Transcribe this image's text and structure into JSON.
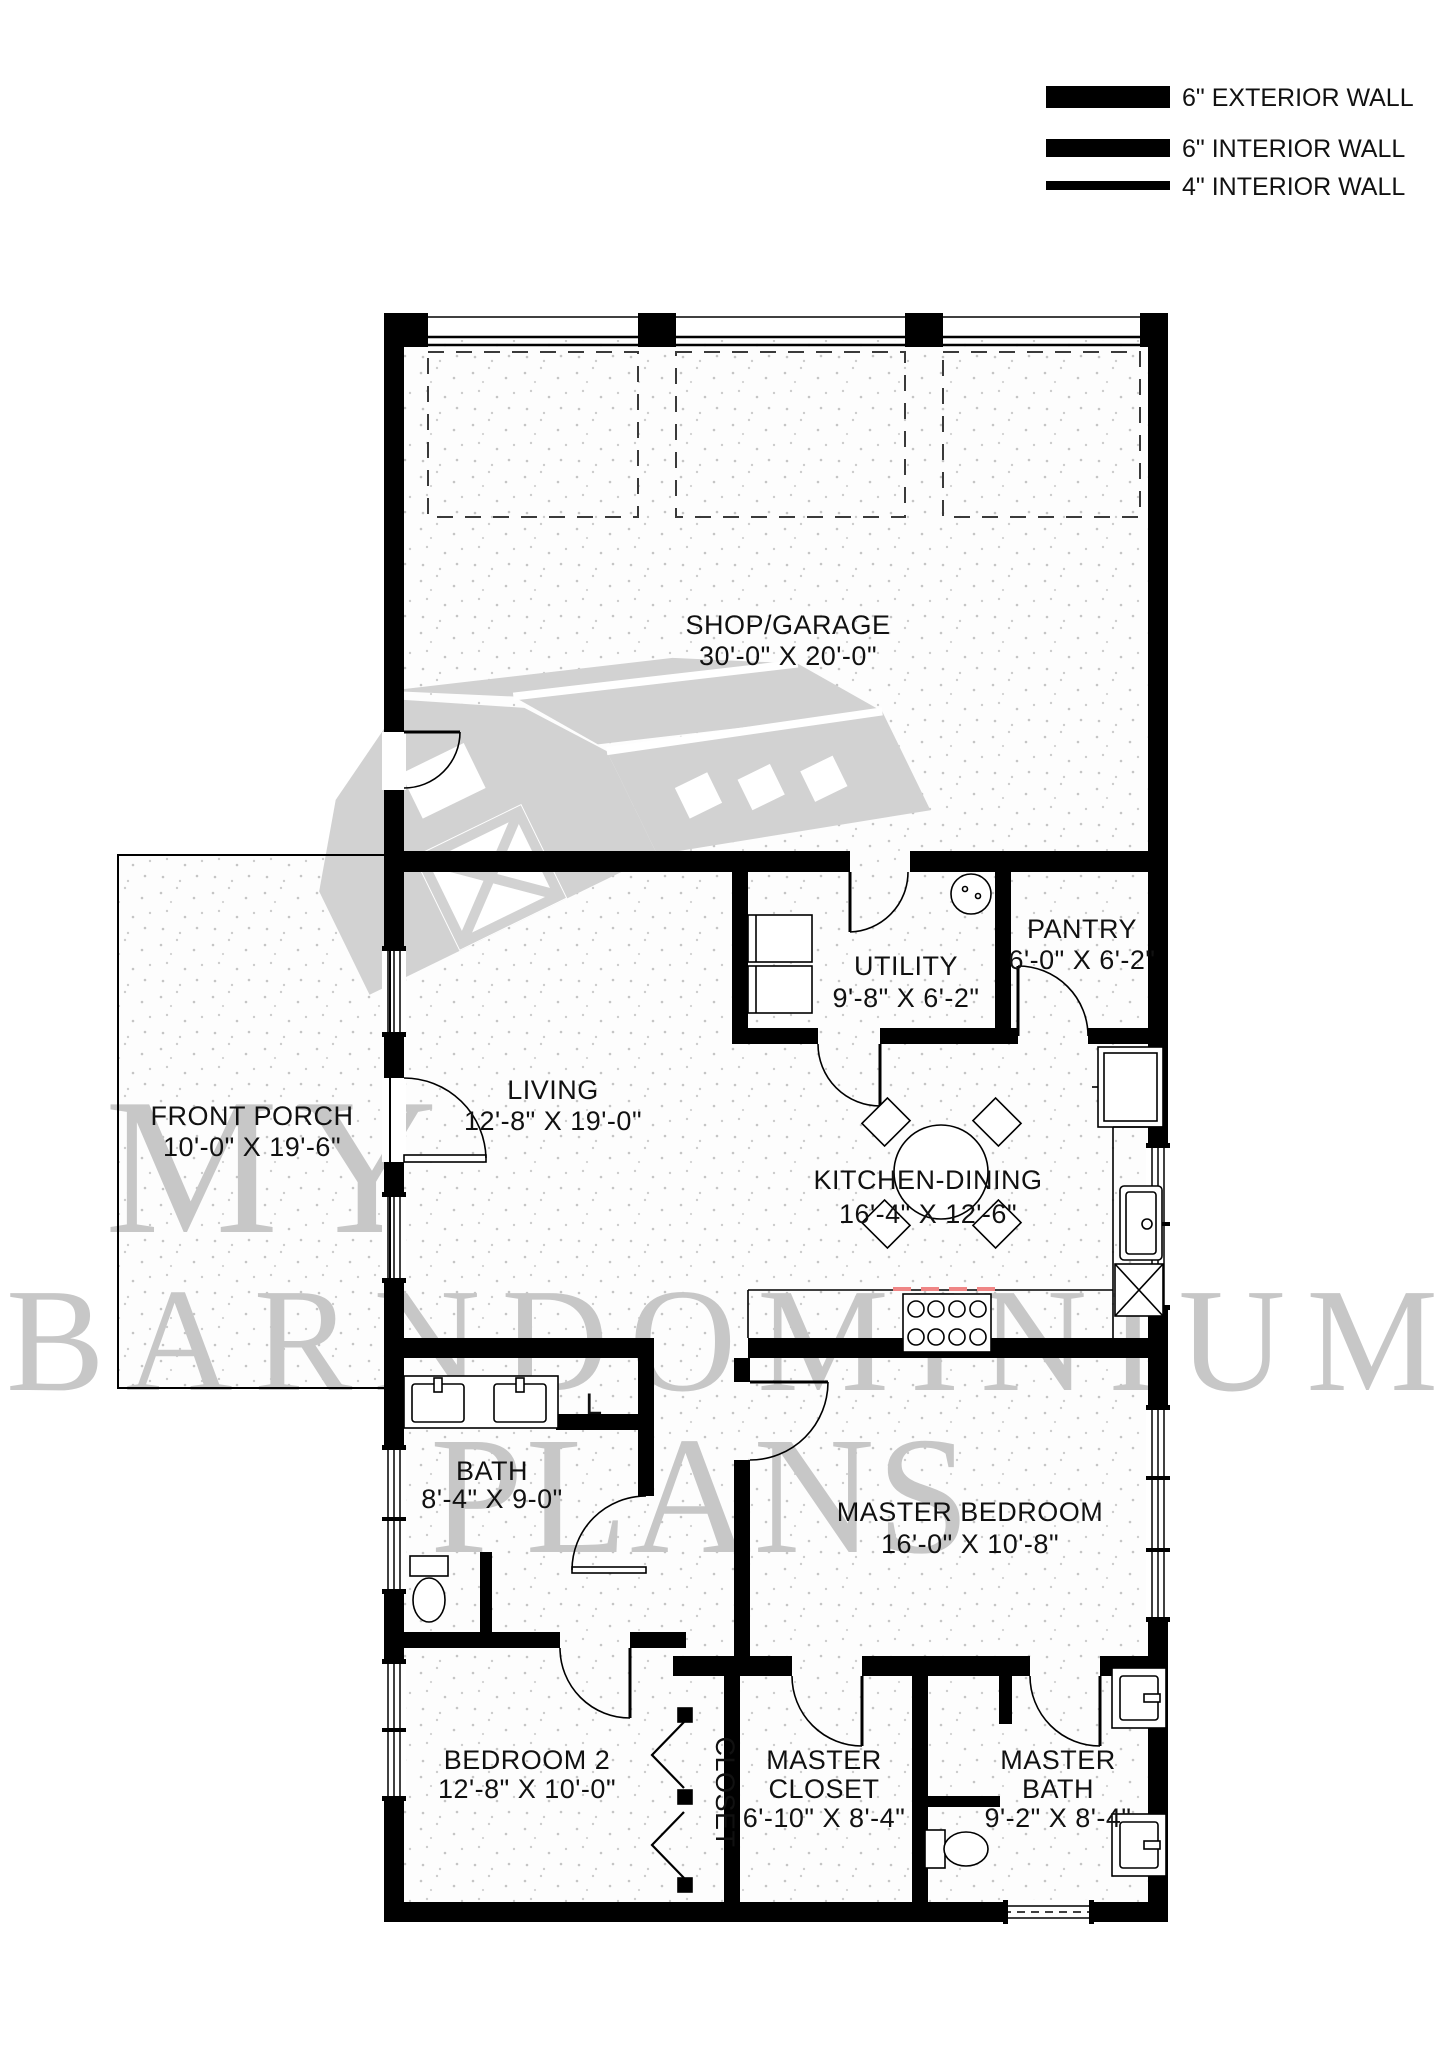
{
  "legend": {
    "items": [
      {
        "label": "6\" EXTERIOR WALL",
        "bar_thickness_px": 22
      },
      {
        "label": "6\" INTERIOR WALL",
        "bar_thickness_px": 18
      },
      {
        "label": "4\" INTERIOR WALL",
        "bar_thickness_px": 9
      }
    ]
  },
  "rooms": {
    "shop": {
      "line1": "SHOP/GARAGE",
      "line2": "30'-0\" X 20'-0\""
    },
    "utility": {
      "line1": "UTILITY",
      "line2": "9'-8\" X 6'-2\""
    },
    "pantry": {
      "line1": "PANTRY",
      "line2": "6'-0\" X 6'-2\""
    },
    "front_porch": {
      "line1": "FRONT PORCH",
      "line2": "10'-0\" X 19'-6\""
    },
    "living": {
      "line1": "LIVING",
      "line2": "12'-8\" X 19'-0\""
    },
    "kitchen": {
      "line1": "KITCHEN-DINING",
      "line2": "16'-4\" X 12'-6\""
    },
    "bath": {
      "line1": "BATH",
      "line2": "8'-4\" X 9-0\""
    },
    "master_bedroom": {
      "line1": "MASTER BEDROOM",
      "line2": "16'-0\" X 10'-8\""
    },
    "bedroom2": {
      "line1": "BEDROOM 2",
      "line2": "12'-8\" X 10'-0\""
    },
    "closet": {
      "line1": "CLOSET"
    },
    "master_closet": {
      "line1": "MASTER",
      "line2": "CLOSET",
      "line3": "6'-10\" X 8'-4\""
    },
    "master_bath": {
      "line1": "MASTER",
      "line2": "BATH",
      "line3": "9'-2\" X 8'-4\""
    }
  },
  "labels": {
    "linen": "L"
  },
  "watermark": {
    "line1": "MY",
    "line2": "BARNDOMINIUM",
    "line3": "PLANS"
  },
  "colors": {
    "wall": "#000000",
    "watermark_text": "#c7c7c7",
    "barn_logo": "#d2d2d2",
    "stove_alert_dash": "#ef8585",
    "floor_speckle": "#c5c5c5"
  }
}
